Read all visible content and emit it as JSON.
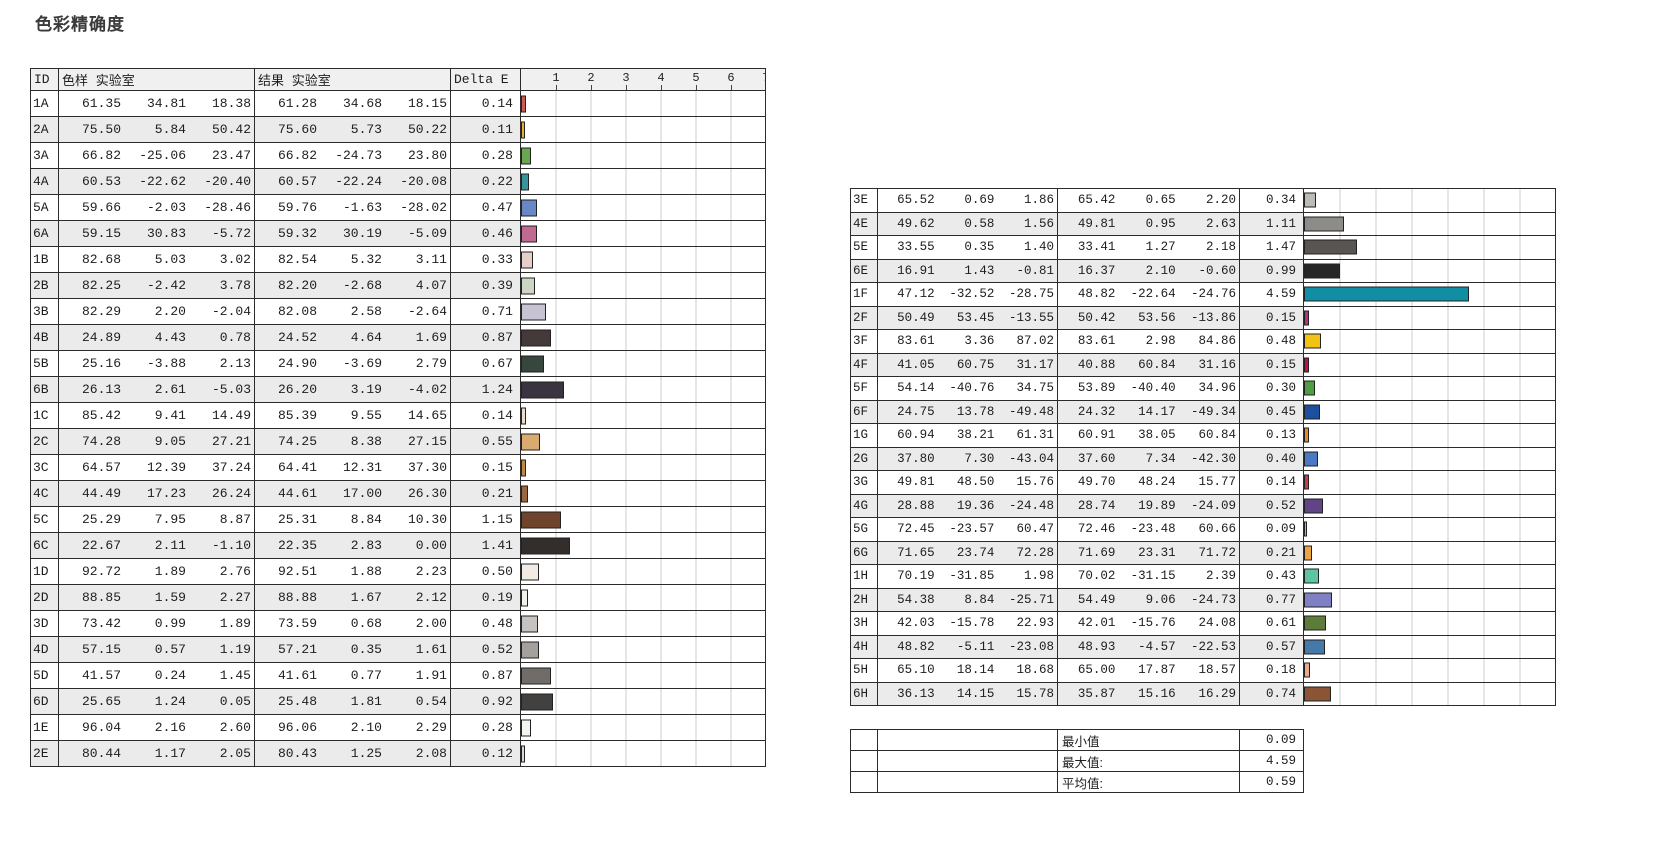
{
  "page": {
    "title": "色彩精确度",
    "background": "#ffffff"
  },
  "colors": {
    "border": "#2b2b2b",
    "row_alt_bg": "#ebebeb",
    "header_bg": "#f0f0f0",
    "gridline": "#cccccc",
    "bar_border": "#222222"
  },
  "left_table": {
    "headers": {
      "id": "ID",
      "sample": "色样 实验室",
      "result": "结果 实验室",
      "delta": "Delta E"
    },
    "scale_ticks": [
      "1",
      "2",
      "3",
      "4",
      "5",
      "6",
      "7"
    ],
    "scale_max": 7,
    "rows": [
      {
        "id": "1A",
        "sample": [
          "61.35",
          "34.81",
          "18.38"
        ],
        "result": [
          "61.28",
          "34.68",
          "18.15"
        ],
        "delta": "0.14",
        "color": "#cf5a55"
      },
      {
        "id": "2A",
        "sample": [
          "75.50",
          "5.84",
          "50.42"
        ],
        "result": [
          "75.60",
          "5.73",
          "50.22"
        ],
        "delta": "0.11",
        "color": "#e0b13a"
      },
      {
        "id": "3A",
        "sample": [
          "66.82",
          "-25.06",
          "23.47"
        ],
        "result": [
          "66.82",
          "-24.73",
          "23.80"
        ],
        "delta": "0.28",
        "color": "#6aa550"
      },
      {
        "id": "4A",
        "sample": [
          "60.53",
          "-22.62",
          "-20.40"
        ],
        "result": [
          "60.57",
          "-22.24",
          "-20.08"
        ],
        "delta": "0.22",
        "color": "#3a949c"
      },
      {
        "id": "5A",
        "sample": [
          "59.66",
          "-2.03",
          "-28.46"
        ],
        "result": [
          "59.76",
          "-1.63",
          "-28.02"
        ],
        "delta": "0.47",
        "color": "#6787c5"
      },
      {
        "id": "6A",
        "sample": [
          "59.15",
          "30.83",
          "-5.72"
        ],
        "result": [
          "59.32",
          "30.19",
          "-5.09"
        ],
        "delta": "0.46",
        "color": "#c06a92"
      },
      {
        "id": "1B",
        "sample": [
          "82.68",
          "5.03",
          "3.02"
        ],
        "result": [
          "82.54",
          "5.32",
          "3.11"
        ],
        "delta": "0.33",
        "color": "#e6cfc9"
      },
      {
        "id": "2B",
        "sample": [
          "82.25",
          "-2.42",
          "3.78"
        ],
        "result": [
          "82.20",
          "-2.68",
          "4.07"
        ],
        "delta": "0.39",
        "color": "#cdd6c0"
      },
      {
        "id": "3B",
        "sample": [
          "82.29",
          "2.20",
          "-2.04"
        ],
        "result": [
          "82.08",
          "2.58",
          "-2.64"
        ],
        "delta": "0.71",
        "color": "#c7c3d3"
      },
      {
        "id": "4B",
        "sample": [
          "24.89",
          "4.43",
          "0.78"
        ],
        "result": [
          "24.52",
          "4.64",
          "1.69"
        ],
        "delta": "0.87",
        "color": "#443a3a"
      },
      {
        "id": "5B",
        "sample": [
          "25.16",
          "-3.88",
          "2.13"
        ],
        "result": [
          "24.90",
          "-3.69",
          "2.79"
        ],
        "delta": "0.67",
        "color": "#38473d"
      },
      {
        "id": "6B",
        "sample": [
          "26.13",
          "2.61",
          "-5.03"
        ],
        "result": [
          "26.20",
          "3.19",
          "-4.02"
        ],
        "delta": "1.24",
        "color": "#393440"
      },
      {
        "id": "1C",
        "sample": [
          "85.42",
          "9.41",
          "14.49"
        ],
        "result": [
          "85.39",
          "9.55",
          "14.65"
        ],
        "delta": "0.14",
        "color": "#eedac6"
      },
      {
        "id": "2C",
        "sample": [
          "74.28",
          "9.05",
          "27.21"
        ],
        "result": [
          "74.25",
          "8.38",
          "27.15"
        ],
        "delta": "0.55",
        "color": "#d9ab70"
      },
      {
        "id": "3C",
        "sample": [
          "64.57",
          "12.39",
          "37.24"
        ],
        "result": [
          "64.41",
          "12.31",
          "37.30"
        ],
        "delta": "0.15",
        "color": "#bd8a44"
      },
      {
        "id": "4C",
        "sample": [
          "44.49",
          "17.23",
          "26.24"
        ],
        "result": [
          "44.61",
          "17.00",
          "26.30"
        ],
        "delta": "0.21",
        "color": "#9b673c"
      },
      {
        "id": "5C",
        "sample": [
          "25.29",
          "7.95",
          "8.87"
        ],
        "result": [
          "25.31",
          "8.84",
          "10.30"
        ],
        "delta": "1.15",
        "color": "#6e452c"
      },
      {
        "id": "6C",
        "sample": [
          "22.67",
          "2.11",
          "-1.10"
        ],
        "result": [
          "22.35",
          "2.83",
          "0.00"
        ],
        "delta": "1.41",
        "color": "#332e2b"
      },
      {
        "id": "1D",
        "sample": [
          "92.72",
          "1.89",
          "2.76"
        ],
        "result": [
          "92.51",
          "1.88",
          "2.23"
        ],
        "delta": "0.50",
        "color": "#f1ebe3"
      },
      {
        "id": "2D",
        "sample": [
          "88.85",
          "1.59",
          "2.27"
        ],
        "result": [
          "88.88",
          "1.67",
          "2.12"
        ],
        "delta": "0.19",
        "color": "#f2f0ec"
      },
      {
        "id": "3D",
        "sample": [
          "73.42",
          "0.99",
          "1.89"
        ],
        "result": [
          "73.59",
          "0.68",
          "2.00"
        ],
        "delta": "0.48",
        "color": "#c5c2bf"
      },
      {
        "id": "4D",
        "sample": [
          "57.15",
          "0.57",
          "1.19"
        ],
        "result": [
          "57.21",
          "0.35",
          "1.61"
        ],
        "delta": "0.52",
        "color": "#a4a19d"
      },
      {
        "id": "5D",
        "sample": [
          "41.57",
          "0.24",
          "1.45"
        ],
        "result": [
          "41.61",
          "0.77",
          "1.91"
        ],
        "delta": "0.87",
        "color": "#6f6c69"
      },
      {
        "id": "6D",
        "sample": [
          "25.65",
          "1.24",
          "0.05"
        ],
        "result": [
          "25.48",
          "1.81",
          "0.54"
        ],
        "delta": "0.92",
        "color": "#434140"
      },
      {
        "id": "1E",
        "sample": [
          "96.04",
          "2.16",
          "2.60"
        ],
        "result": [
          "96.06",
          "2.10",
          "2.29"
        ],
        "delta": "0.28",
        "color": "#f5f3ef"
      },
      {
        "id": "2E",
        "sample": [
          "80.44",
          "1.17",
          "2.05"
        ],
        "result": [
          "80.43",
          "1.25",
          "2.08"
        ],
        "delta": "0.12",
        "color": "#dcd9d4"
      }
    ]
  },
  "right_table": {
    "scale_max": 7,
    "rows": [
      {
        "id": "3E",
        "sample": [
          "65.52",
          "0.69",
          "1.86"
        ],
        "result": [
          "65.42",
          "0.65",
          "2.20"
        ],
        "delta": "0.34",
        "color": "#bdbbb8"
      },
      {
        "id": "4E",
        "sample": [
          "49.62",
          "0.58",
          "1.56"
        ],
        "result": [
          "49.81",
          "0.95",
          "2.63"
        ],
        "delta": "1.11",
        "color": "#8e8c89"
      },
      {
        "id": "5E",
        "sample": [
          "33.55",
          "0.35",
          "1.40"
        ],
        "result": [
          "33.41",
          "1.27",
          "2.18"
        ],
        "delta": "1.47",
        "color": "#585552"
      },
      {
        "id": "6E",
        "sample": [
          "16.91",
          "1.43",
          "-0.81"
        ],
        "result": [
          "16.37",
          "2.10",
          "-0.60"
        ],
        "delta": "0.99",
        "color": "#282625"
      },
      {
        "id": "1F",
        "sample": [
          "47.12",
          "-32.52",
          "-28.75"
        ],
        "result": [
          "48.82",
          "-22.64",
          "-24.76"
        ],
        "delta": "4.59",
        "color": "#118ea3"
      },
      {
        "id": "2F",
        "sample": [
          "50.49",
          "53.45",
          "-13.55"
        ],
        "result": [
          "50.42",
          "53.56",
          "-13.86"
        ],
        "delta": "0.15",
        "color": "#b23181"
      },
      {
        "id": "3F",
        "sample": [
          "83.61",
          "3.36",
          "87.02"
        ],
        "result": [
          "83.61",
          "2.98",
          "84.86"
        ],
        "delta": "0.48",
        "color": "#f3c314"
      },
      {
        "id": "4F",
        "sample": [
          "41.05",
          "60.75",
          "31.17"
        ],
        "result": [
          "40.88",
          "60.84",
          "31.16"
        ],
        "delta": "0.15",
        "color": "#c40f3f"
      },
      {
        "id": "5F",
        "sample": [
          "54.14",
          "-40.76",
          "34.75"
        ],
        "result": [
          "53.89",
          "-40.40",
          "34.96"
        ],
        "delta": "0.30",
        "color": "#4f9e43"
      },
      {
        "id": "6F",
        "sample": [
          "24.75",
          "13.78",
          "-49.48"
        ],
        "result": [
          "24.32",
          "14.17",
          "-49.34"
        ],
        "delta": "0.45",
        "color": "#1c4f9e"
      },
      {
        "id": "1G",
        "sample": [
          "60.94",
          "38.21",
          "61.31"
        ],
        "result": [
          "60.91",
          "38.05",
          "60.84"
        ],
        "delta": "0.13",
        "color": "#e28c26"
      },
      {
        "id": "2G",
        "sample": [
          "37.80",
          "7.30",
          "-43.04"
        ],
        "result": [
          "37.60",
          "7.34",
          "-42.30"
        ],
        "delta": "0.40",
        "color": "#4a78c3"
      },
      {
        "id": "3G",
        "sample": [
          "49.81",
          "48.50",
          "15.76"
        ],
        "result": [
          "49.70",
          "48.24",
          "15.77"
        ],
        "delta": "0.14",
        "color": "#c93b4c"
      },
      {
        "id": "4G",
        "sample": [
          "28.88",
          "19.36",
          "-24.48"
        ],
        "result": [
          "28.74",
          "19.89",
          "-24.09"
        ],
        "delta": "0.52",
        "color": "#5f4585"
      },
      {
        "id": "5G",
        "sample": [
          "72.45",
          "-23.57",
          "60.47"
        ],
        "result": [
          "72.46",
          "-23.48",
          "60.66"
        ],
        "delta": "0.09",
        "color": "#abce3e"
      },
      {
        "id": "6G",
        "sample": [
          "71.65",
          "23.74",
          "72.28"
        ],
        "result": [
          "71.69",
          "23.31",
          "71.72"
        ],
        "delta": "0.21",
        "color": "#eda63f"
      },
      {
        "id": "1H",
        "sample": [
          "70.19",
          "-31.85",
          "1.98"
        ],
        "result": [
          "70.02",
          "-31.15",
          "2.39"
        ],
        "delta": "0.43",
        "color": "#5ac6a2"
      },
      {
        "id": "2H",
        "sample": [
          "54.38",
          "8.84",
          "-25.71"
        ],
        "result": [
          "54.49",
          "9.06",
          "-24.73"
        ],
        "delta": "0.77",
        "color": "#8081c5"
      },
      {
        "id": "3H",
        "sample": [
          "42.03",
          "-15.78",
          "22.93"
        ],
        "result": [
          "42.01",
          "-15.76",
          "24.08"
        ],
        "delta": "0.61",
        "color": "#5d7c3a"
      },
      {
        "id": "4H",
        "sample": [
          "48.82",
          "-5.11",
          "-23.08"
        ],
        "result": [
          "48.93",
          "-4.57",
          "-22.53"
        ],
        "delta": "0.57",
        "color": "#4679a9"
      },
      {
        "id": "5H",
        "sample": [
          "65.10",
          "18.14",
          "18.68"
        ],
        "result": [
          "65.00",
          "17.87",
          "18.57"
        ],
        "delta": "0.18",
        "color": "#ebaa8c"
      },
      {
        "id": "6H",
        "sample": [
          "36.13",
          "14.15",
          "15.78"
        ],
        "result": [
          "35.87",
          "15.16",
          "16.29"
        ],
        "delta": "0.74",
        "color": "#8b5535"
      }
    ],
    "summary": [
      {
        "label": "最小值",
        "value": "0.09"
      },
      {
        "label": "最大值:",
        "value": "4.59"
      },
      {
        "label": "平均值:",
        "value": "0.59"
      }
    ]
  },
  "chart_data": [
    {
      "type": "bar",
      "orientation": "horizontal",
      "title": "色彩精确度 Delta E — patches 1A–2E",
      "xlabel": "Delta E",
      "xlim": [
        0,
        7
      ],
      "xticks": [
        1,
        2,
        3,
        4,
        5,
        6,
        7
      ],
      "grid": true,
      "categories": [
        "1A",
        "2A",
        "3A",
        "4A",
        "5A",
        "6A",
        "1B",
        "2B",
        "3B",
        "4B",
        "5B",
        "6B",
        "1C",
        "2C",
        "3C",
        "4C",
        "5C",
        "6C",
        "1D",
        "2D",
        "3D",
        "4D",
        "5D",
        "6D",
        "1E",
        "2E"
      ],
      "values": [
        0.14,
        0.11,
        0.28,
        0.22,
        0.47,
        0.46,
        0.33,
        0.39,
        0.71,
        0.87,
        0.67,
        1.24,
        0.14,
        0.55,
        0.15,
        0.21,
        1.15,
        1.41,
        0.5,
        0.19,
        0.48,
        0.52,
        0.87,
        0.92,
        0.28,
        0.12
      ],
      "bar_colors": [
        "#cf5a55",
        "#e0b13a",
        "#6aa550",
        "#3a949c",
        "#6787c5",
        "#c06a92",
        "#e6cfc9",
        "#cdd6c0",
        "#c7c3d3",
        "#443a3a",
        "#38473d",
        "#393440",
        "#eedac6",
        "#d9ab70",
        "#bd8a44",
        "#9b673c",
        "#6e452c",
        "#332e2b",
        "#f1ebe3",
        "#f2f0ec",
        "#c5c2bf",
        "#a4a19d",
        "#6f6c69",
        "#434140",
        "#f5f3ef",
        "#dcd9d4"
      ]
    },
    {
      "type": "bar",
      "orientation": "horizontal",
      "title": "色彩精确度 Delta E — patches 3E–6H",
      "xlabel": "Delta E",
      "xlim": [
        0,
        7
      ],
      "grid": true,
      "categories": [
        "3E",
        "4E",
        "5E",
        "6E",
        "1F",
        "2F",
        "3F",
        "4F",
        "5F",
        "6F",
        "1G",
        "2G",
        "3G",
        "4G",
        "5G",
        "6G",
        "1H",
        "2H",
        "3H",
        "4H",
        "5H",
        "6H"
      ],
      "values": [
        0.34,
        1.11,
        1.47,
        0.99,
        4.59,
        0.15,
        0.48,
        0.15,
        0.3,
        0.45,
        0.13,
        0.4,
        0.14,
        0.52,
        0.09,
        0.21,
        0.43,
        0.77,
        0.61,
        0.57,
        0.18,
        0.74
      ],
      "bar_colors": [
        "#bdbbb8",
        "#8e8c89",
        "#585552",
        "#282625",
        "#118ea3",
        "#b23181",
        "#f3c314",
        "#c40f3f",
        "#4f9e43",
        "#1c4f9e",
        "#e28c26",
        "#4a78c3",
        "#c93b4c",
        "#5f4585",
        "#abce3e",
        "#eda63f",
        "#5ac6a2",
        "#8081c5",
        "#5d7c3a",
        "#4679a9",
        "#ebaa8c",
        "#8b5535"
      ],
      "summary": {
        "min": 0.09,
        "max": 4.59,
        "mean": 0.59
      }
    }
  ]
}
